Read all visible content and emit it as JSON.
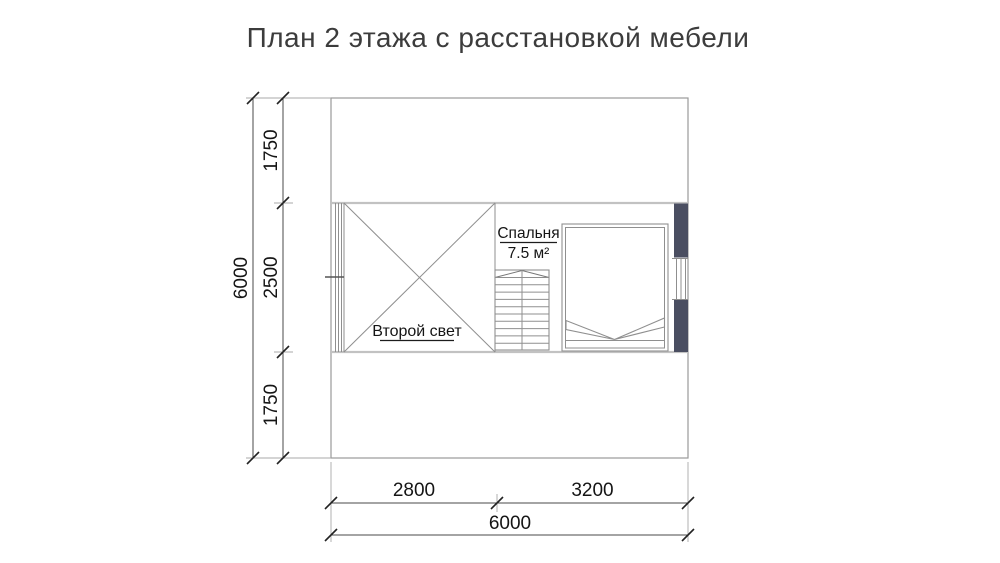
{
  "title": "План 2 этажа с расстановкой мебели",
  "plan": {
    "rooms": {
      "bedroom_label": "Спальня",
      "bedroom_area": "7.5 м²",
      "void_label": "Второй свет"
    },
    "colors": {
      "wall_fill": "#4a4e61",
      "wall_stroke": "#23273a"
    }
  },
  "dimensions": {
    "left": {
      "total": "6000",
      "segments": [
        "1750",
        "2500",
        "1750"
      ]
    },
    "bottom": {
      "total": "6000",
      "segments": [
        "2800",
        "3200"
      ]
    }
  }
}
